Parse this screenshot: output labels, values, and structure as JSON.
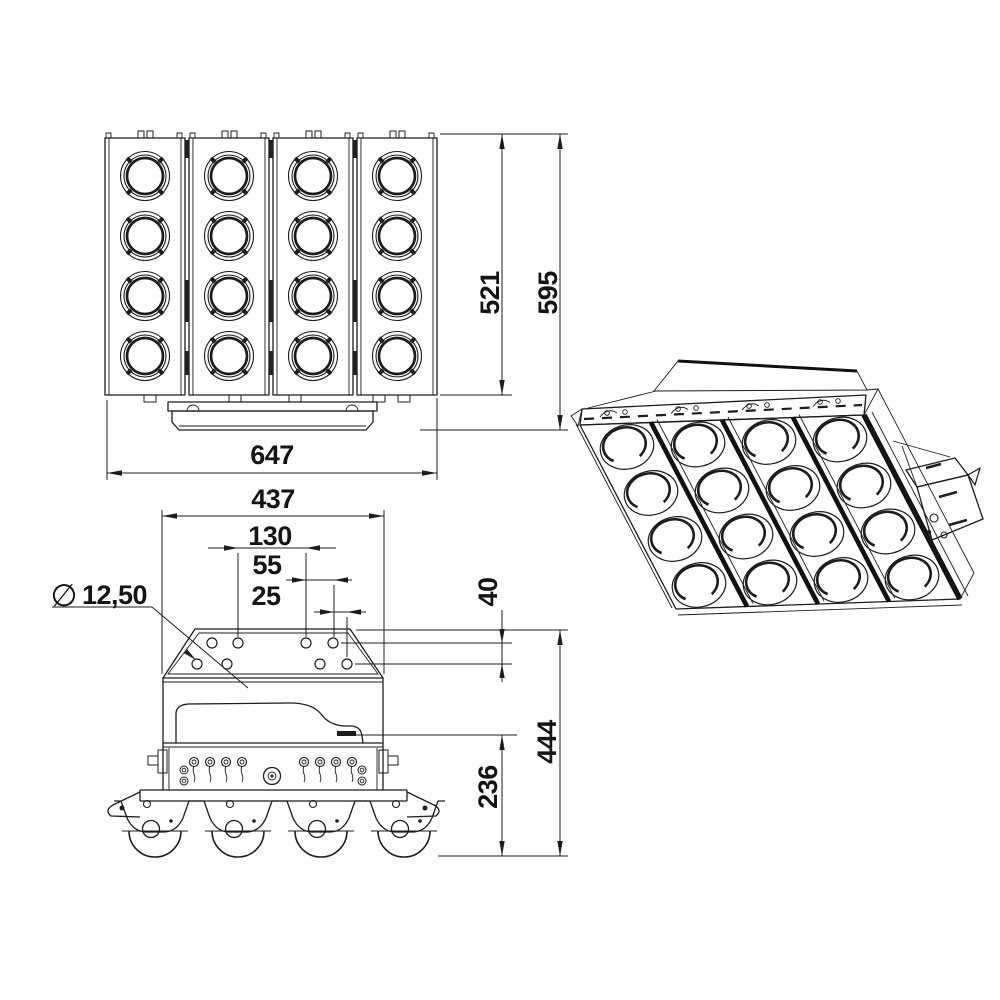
{
  "drawing": {
    "type": "technical-dimension-drawing",
    "views": {
      "front": "front-view",
      "side": "side-view",
      "iso": "isometric-view"
    },
    "dimensions": {
      "front_width": "647",
      "front_glass_height": "521",
      "front_total_height": "595",
      "side_width": "437",
      "mount_hole_pitch": "130",
      "mount_hole_offset_mid": "55",
      "mount_hole_offset_small": "25",
      "mount_hole_diameter_symbol": "∅",
      "mount_hole_diameter": "12,50",
      "mount_hole_row_gap": "40",
      "side_total_height": "444",
      "side_lower_height": "236"
    },
    "colors": {
      "line": "#1c1c1c",
      "background": "#ffffff"
    }
  }
}
